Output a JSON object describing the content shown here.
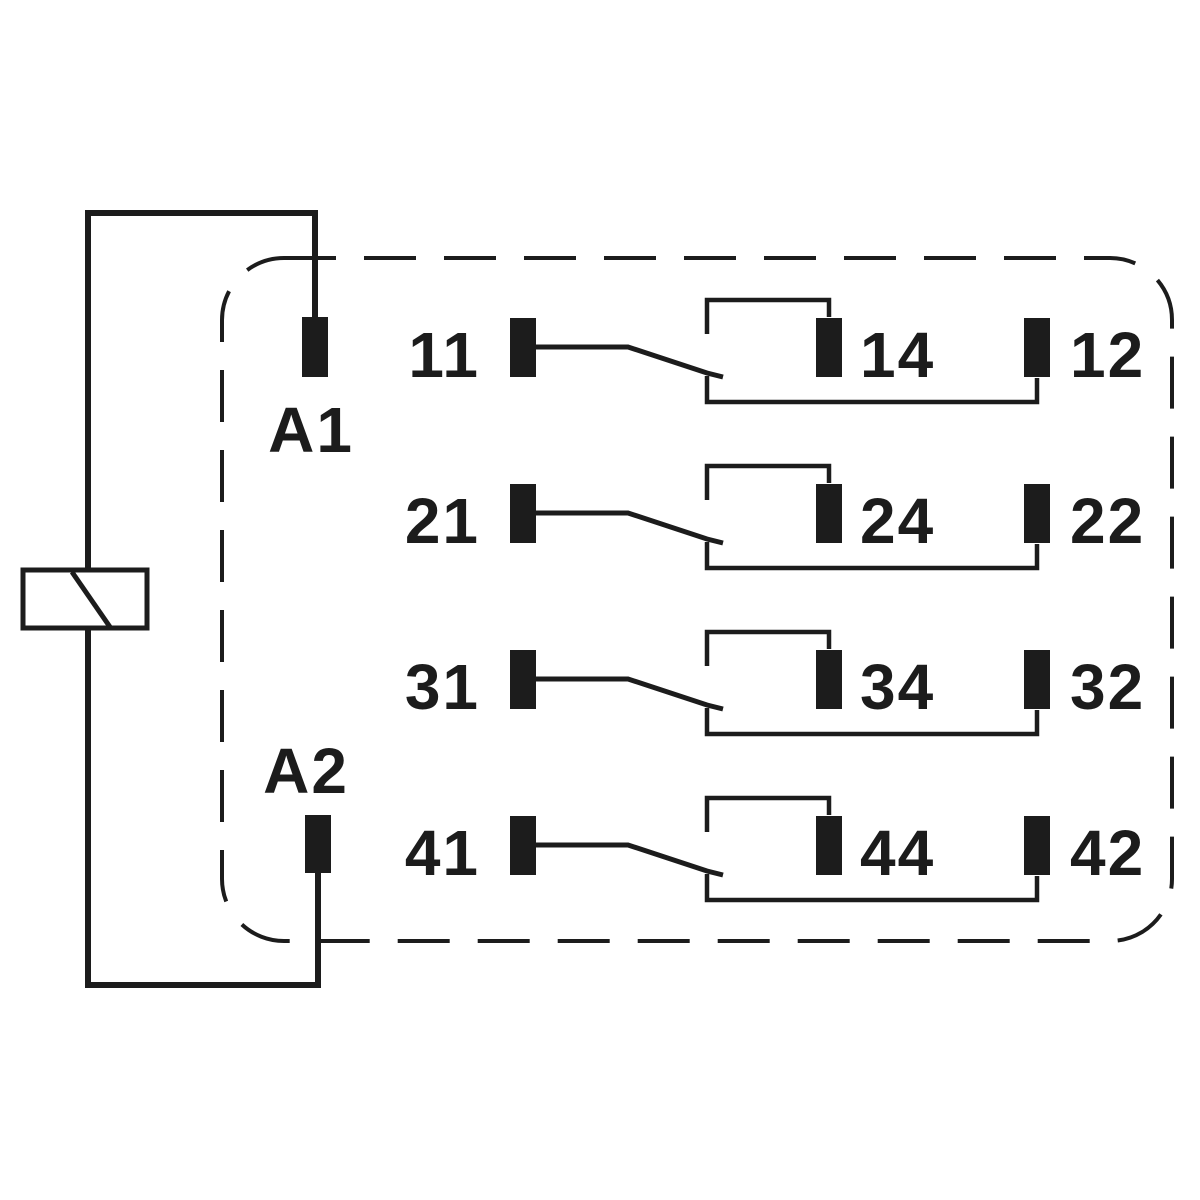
{
  "diagram": {
    "kind": "relay-contact-schematic",
    "colors": {
      "line": "#1c1c1c",
      "background": "#ffffff"
    },
    "coil": {
      "terminal_top": "A1",
      "terminal_bottom": "A2"
    },
    "poles": [
      {
        "common": "11",
        "no": "14",
        "nc": "12"
      },
      {
        "common": "21",
        "no": "24",
        "nc": "22"
      },
      {
        "common": "31",
        "no": "34",
        "nc": "32"
      },
      {
        "common": "41",
        "no": "44",
        "nc": "42"
      }
    ]
  }
}
